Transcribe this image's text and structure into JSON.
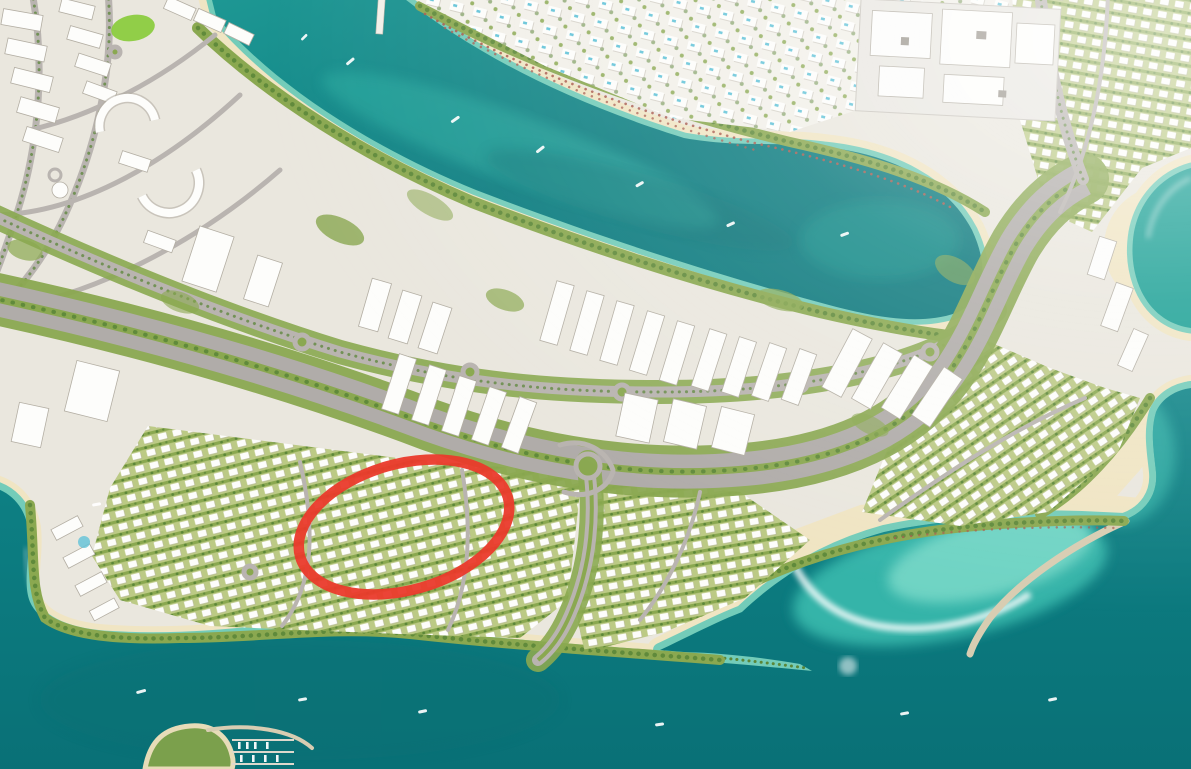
{
  "window": {
    "width": 1191,
    "height": 769,
    "description": "Aerial masterplan rendering of a coastal island development, no visible text, with a red ellipse annotation highlighting a villa cluster"
  },
  "colors": {
    "sea_deep": "#0a777c",
    "sea_mid": "#0f8588",
    "lagoon_dark": "#0d7e81",
    "lagoon_light": "#1e9894",
    "cove_teal": "#1aa095",
    "shallow": "#54c6b6",
    "foam": "#ffffff",
    "sand": "#f0e5c3",
    "sand_dark": "#e4d4a9",
    "land": "#eae7de",
    "land_pale": "#f2f0e9",
    "green_dark": "#5b8638",
    "green_mid": "#8aa850",
    "green_light": "#bcca85",
    "lawn": "#8ccc3f",
    "road": "#b9b4b0",
    "road_major": "#b0aca9",
    "building": "#fdfdfb",
    "building_shadow": "#b3aea3",
    "mall_roof": "#e9e7e1",
    "pool": "#62c3d8",
    "umbrella": "#a85a4c",
    "breakwater": "#d8cdb2",
    "annotation_red": "#ea3a2b"
  },
  "annotation": {
    "type": "ellipse",
    "cx": 404,
    "cy": 527,
    "rx": 108,
    "ry": 63,
    "rotation_deg": -16,
    "transform": "rotate(-16 404 527)",
    "stroke_width": 10.5,
    "label": "highlighted-villa-cluster"
  },
  "map": {
    "features": [
      "open-sea",
      "lagoon-channel-between-islands",
      "north-island-beach-resorts",
      "shopping-mall-complex",
      "beach-umbrella-rows",
      "mid-rise-apartment-district",
      "villa-districts",
      "main-boulevard-with-green-median",
      "interchange",
      "curved-breakwater-jetty",
      "south-sand-spit",
      "marina-with-docked-boats",
      "turquoise-beach-cove",
      "small-boats-in-water",
      "red-ellipse-annotation"
    ]
  }
}
